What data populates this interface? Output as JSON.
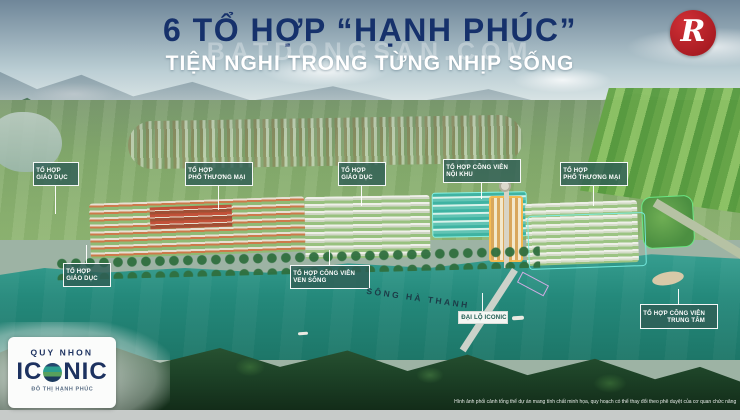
{
  "header": {
    "title_line1": "6 TỔ HỢP “HẠNH PHÚC”",
    "title_line2": "TIỆN NGHI TRONG TỪNG NHỊP SỐNG",
    "watermark_text": "BATDONGSAN.COM",
    "title_color": "#16316b"
  },
  "corner_logo": {
    "letter": "R",
    "bg_color": "#a81b22"
  },
  "project_logo": {
    "name_top": "QUY NHON",
    "name_main_prefix": "IC",
    "name_main_suffix": "NIC",
    "tagline": "ĐÔ THỊ HẠNH PHÚC",
    "text_color": "#1d3260"
  },
  "map": {
    "labels": [
      {
        "line1": "TỔ HỢP",
        "line2": "GIÁO DỤC"
      },
      {
        "line1": "TỔ HỢP",
        "line2": "PHỐ THƯƠNG MẠI"
      },
      {
        "line1": "TỔ HỢP",
        "line2": "GIÁO DỤC"
      },
      {
        "line1": "TỔ HỢP CÔNG VIÊN",
        "line2": "NỘI KHU"
      },
      {
        "line1": "TỔ HỢP",
        "line2": "PHỐ THƯƠNG MẠI"
      },
      {
        "line1": "TỔ HỢP",
        "line2": "GIÁO DỤC"
      },
      {
        "line1": "TỔ HỢP CÔNG VIÊN",
        "line2": "VEN SÔNG"
      },
      {
        "line1": "TỔ HỢP CÔNG VIÊN",
        "line2": "TRUNG TÂM"
      }
    ],
    "river_name": "SÔNG HÀ THANH",
    "boulevard_label": "ĐẠI LỘ ICONIC",
    "label_bg_color": "#2f5e56",
    "river_color": "#24897b"
  },
  "footer": {
    "disclaimer": "Hình ảnh phối cảnh tổng thể dự án mang tính chất minh họa, quy hoạch có thể thay đổi theo phê duyệt của cơ quan chức năng"
  }
}
